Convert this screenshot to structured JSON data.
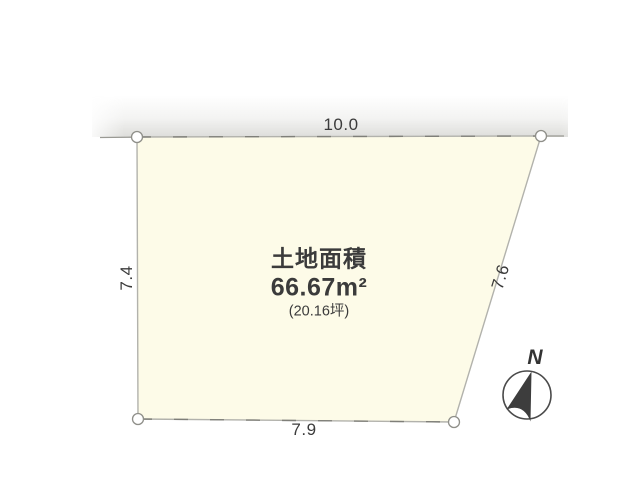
{
  "diagram": {
    "title": "土地面積",
    "area_m2": "66.67m²",
    "area_tsubo": "(20.16坪)",
    "dimensions": {
      "top": "10.0",
      "bottom": "7.9",
      "left": "7.4",
      "right": "7.6"
    },
    "compass": {
      "north_label": "N"
    },
    "colors": {
      "plot_fill": "#FDFBE8",
      "boundary_line": "#b2b2ac",
      "boundary_dash": "#7f7f79",
      "road_line": "#9a9a94",
      "marker_stroke": "#8f8f89",
      "compass_stroke": "#4a4a4a",
      "compass_needle": "#3d3d3d",
      "text": "#3b3b3b"
    }
  }
}
